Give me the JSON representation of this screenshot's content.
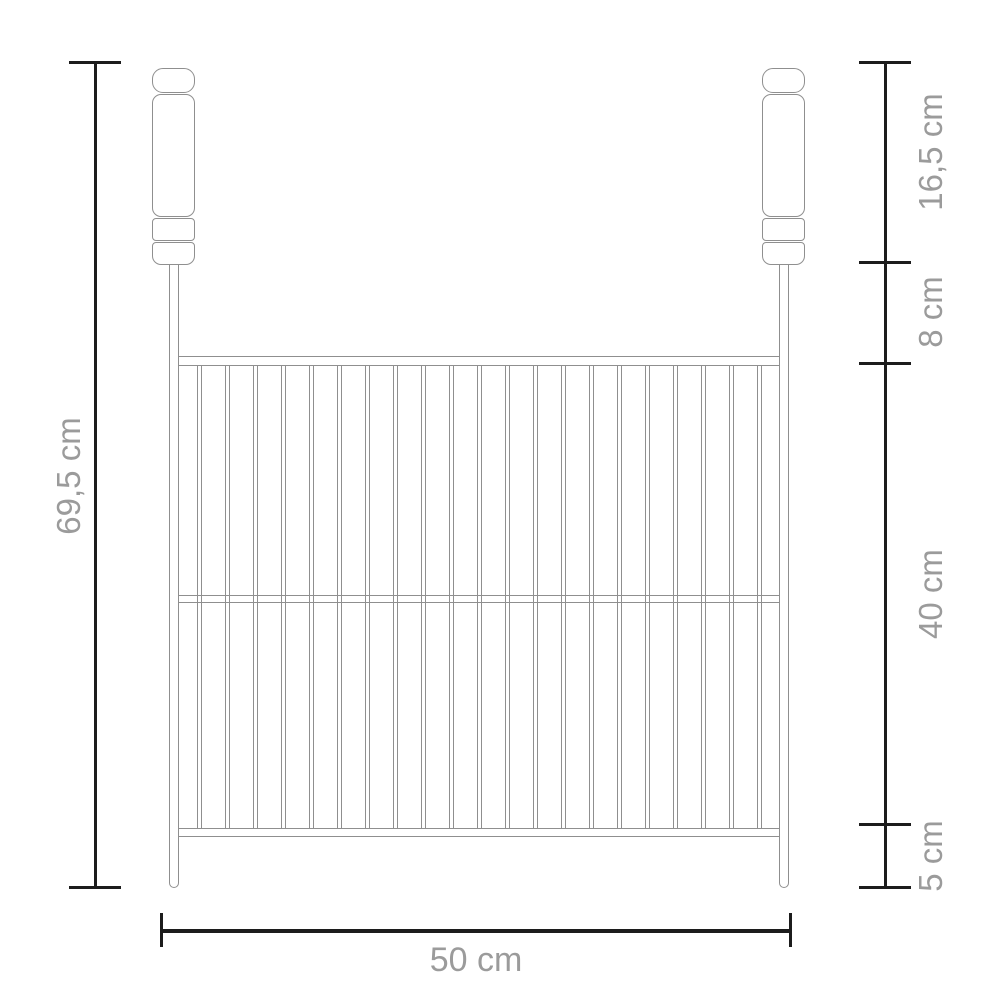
{
  "diagram": {
    "type": "product-dimension-drawing",
    "subject": "barbecue-grill-grate-with-two-handles",
    "labels": {
      "total_height": "69,5 cm",
      "handle_height": "16,5 cm",
      "hanger_gap": "8 cm",
      "grid_height": "40 cm",
      "bottom_clearance": "5 cm",
      "width": "50 cm"
    },
    "grill": {
      "bar_count": 21,
      "rail_count": 3,
      "handle_count": 2
    },
    "colors": {
      "dimension_line": "#1c1c1c",
      "label_text": "#9b9b9b",
      "drawing_line": "#8f8f8f",
      "background": "#ffffff"
    }
  }
}
